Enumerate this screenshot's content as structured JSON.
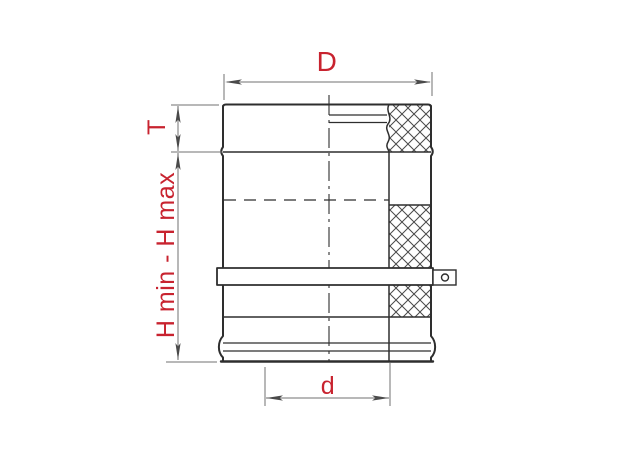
{
  "dimension_labels": {
    "outer_diameter": "D",
    "collar_height": "T",
    "height_range": "H min - H max",
    "inner_diameter": "d"
  },
  "colors": {
    "background": "#ffffff",
    "object_line": "#2e2e2e",
    "dimension_line": "#707070",
    "arrowhead": "#4a4a4a",
    "hatch_line": "#4a4a4a",
    "label_red": "#c8232f"
  }
}
